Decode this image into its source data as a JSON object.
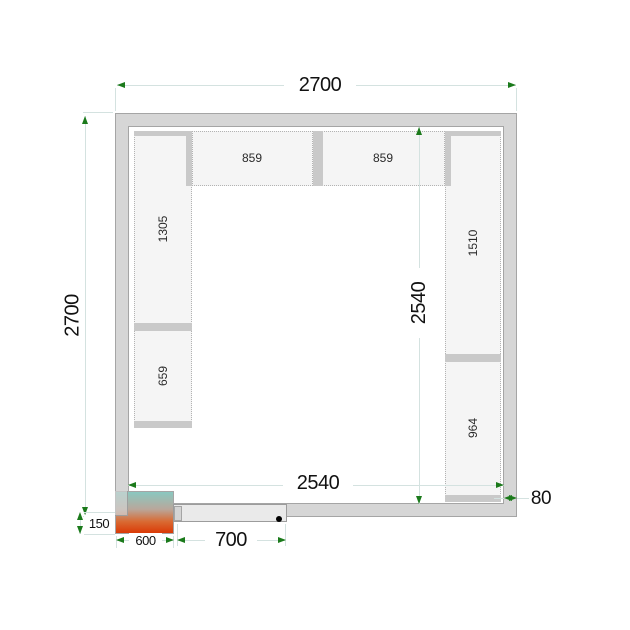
{
  "plan": {
    "dimensions": {
      "outer_width": "2700",
      "outer_depth": "2700",
      "inner_depth": "2540",
      "inner_width": "2540",
      "wall_thickness": "80",
      "unit_protrusion": "150",
      "unit_width": "600",
      "door_width": "700"
    },
    "shelf_labels": {
      "top_left": "859",
      "top_right": "859",
      "left_upper": "1305",
      "left_lower": "659",
      "right_upper": "1510",
      "right_lower": "964"
    },
    "colors": {
      "dimension_line": "#d4e2e0",
      "arrow_green": "#1b7a1b",
      "wall_fill": "#d6d6d6",
      "shelf_fill": "#f5f5f5",
      "shelf_bar": "#c9c9c9",
      "unit_gradient_top": "#8ac8c0",
      "unit_gradient_bottom": "#da3a06"
    }
  }
}
